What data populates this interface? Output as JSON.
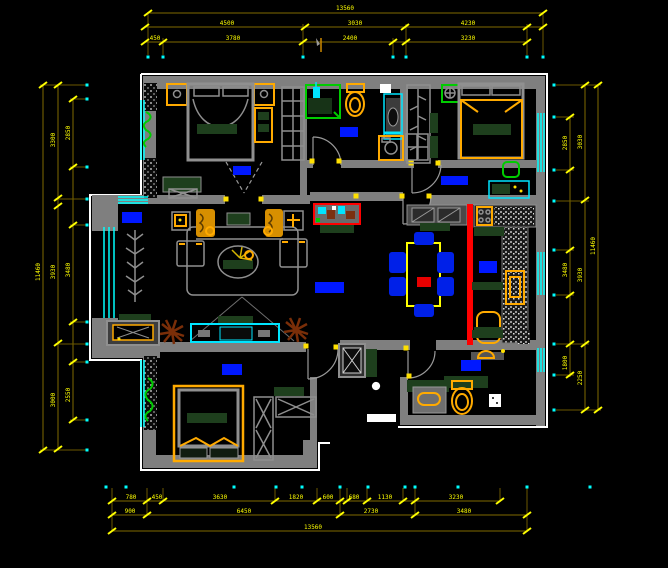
{
  "drawing": {
    "type": "apartment-floor-plan",
    "style": "cad-black-canvas"
  },
  "palette": {
    "background": "#000000",
    "wall_gray": "#7f7f7f",
    "outline_white": "#ffffff",
    "dim_line": "#7f6a00",
    "dim_text_yellow": "#ffff00",
    "extension_dot_cyan": "#00ffff",
    "window_cyan": "#00ffff",
    "selection_blue": "#0018ff",
    "furniture_orange": "#ffaa00",
    "soft_green": "#1e3f1d",
    "bright_green": "#00cc00",
    "accent_red": "#ff0000",
    "chair_blue": "#0020e8",
    "plant_brown": "#7a2e08"
  },
  "dims": {
    "top": {
      "overall": "13560",
      "row2": [
        "4500",
        "3030",
        "4230"
      ],
      "row3": [
        "450",
        "3780",
        "2400",
        "3230"
      ]
    },
    "left": {
      "overall": "11460",
      "row2": [
        "3300",
        "3930",
        "3000"
      ],
      "row3": [
        "2850",
        "3480",
        "2550"
      ]
    },
    "right": {
      "overall": "11460",
      "row2": [
        "3030",
        "3930",
        "2250"
      ],
      "row3": [
        "2850",
        "3480",
        "1800"
      ]
    },
    "bottom": {
      "row1": [
        "780",
        "450",
        "3630",
        "1820",
        "600",
        "680",
        "1130",
        "3230"
      ],
      "row2": [
        "900",
        "6450",
        "2730",
        "3480"
      ],
      "overall": "13560"
    }
  }
}
